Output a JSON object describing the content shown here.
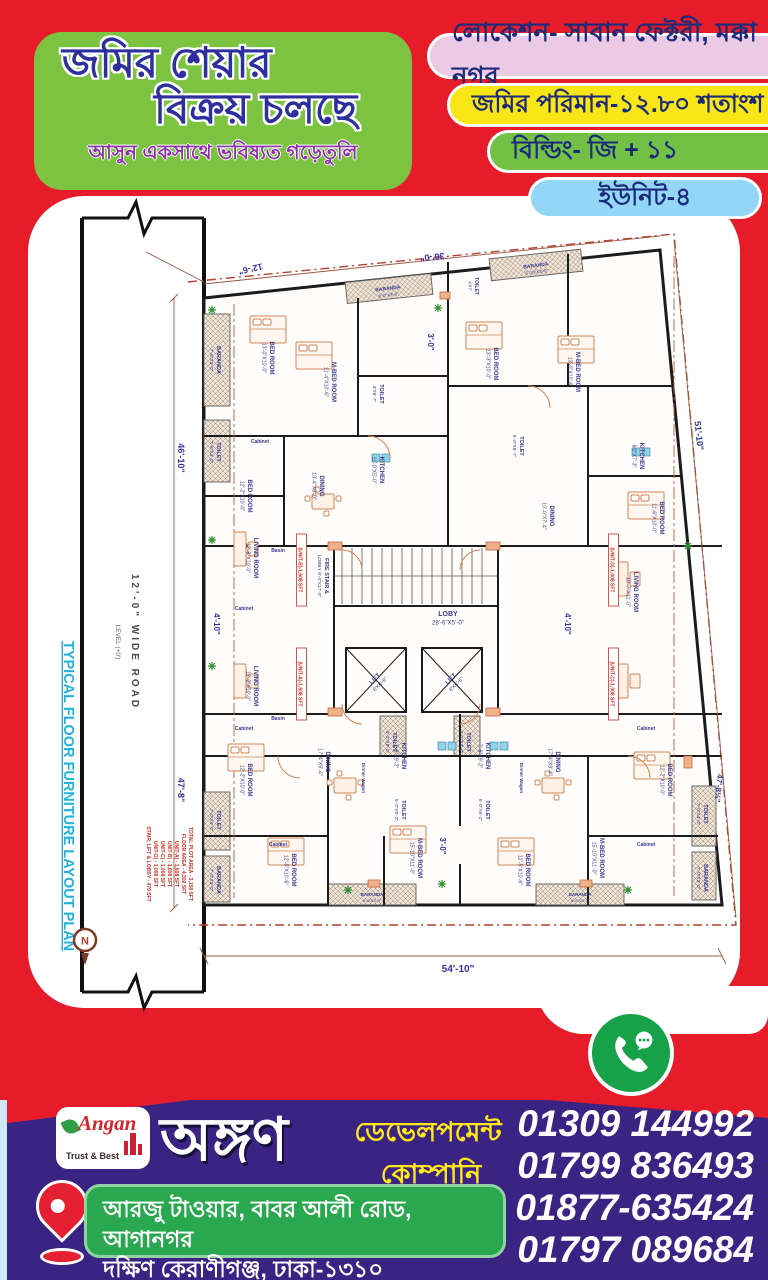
{
  "poster": {
    "title_line1": "জমির শেয়ার",
    "title_line2": "বিক্রয় চলছে",
    "subtitle": "আসুন একসাথে ভবিষ্যত গড়েতুলি",
    "badges": [
      {
        "label": "লোকেশন- সাবান ফেক্টরী, মক্কা নগর"
      },
      {
        "label": "জমির পরিমান-১২.৮০ শতাংশ"
      },
      {
        "label": "বিল্ডিং- জি + ১১"
      },
      {
        "label": "ইউনিট-৪"
      }
    ]
  },
  "colors": {
    "background_red": "#e61c2a",
    "title_card_green": "#7cc342",
    "badge_pink": "#ecc9e4",
    "badge_yellow": "#f8e616",
    "badge_green": "#72c045",
    "badge_cyan": "#93d6f5",
    "banner_purple": "#3a2383",
    "address_green": "#2aa84f",
    "phone_circle_green": "#17a149",
    "dim_text_navy": "#34349a",
    "area_text_red": "#cc2b1f"
  },
  "plan": {
    "side": {
      "road": "12'-0\" WIDE ROAD",
      "road_level": "LEVEL (+0')",
      "plan_title": "TYPICAL FLOOR FURNITURE LAYOUT PLAN",
      "compass": "N"
    },
    "dims": [
      {
        "t": "12'-6\"",
        "x": 222,
        "y": 70,
        "r": 167,
        "s": 9
      },
      {
        "t": "36'-0\"",
        "x": 404,
        "y": 58,
        "r": 174,
        "s": 9
      },
      {
        "t": "51'-10\"",
        "x": 668,
        "y": 240,
        "r": 84,
        "s": 9
      },
      {
        "t": "46'-10\"",
        "x": 150,
        "y": 262,
        "r": 90,
        "s": 9
      },
      {
        "t": "47'-8\"",
        "x": 150,
        "y": 594,
        "r": 90,
        "s": 9
      },
      {
        "t": "4'-10\"",
        "x": 186,
        "y": 428,
        "r": 90,
        "s": 8
      },
      {
        "t": "4'-10\"",
        "x": 537,
        "y": 428,
        "r": 90,
        "s": 8
      },
      {
        "t": "3'-0\"",
        "x": 400,
        "y": 146,
        "r": 90,
        "s": 8
      },
      {
        "t": "3'-0\"",
        "x": 412,
        "y": 650,
        "r": 90,
        "s": 8
      },
      {
        "t": "47'-8½\"",
        "x": 688,
        "y": 592,
        "r": 96,
        "s": 8
      },
      {
        "t": "54'-10\"",
        "x": 430,
        "y": 776,
        "r": 0,
        "s": 10
      }
    ],
    "rooms": [
      {
        "n": "LOBY",
        "d": "28'-6\"X5'-0\"",
        "x": 420,
        "y": 420,
        "r": 0,
        "s": 7
      },
      {
        "n": "FIRE STAIR &",
        "d": "LOBBY 8'-0\"X17'-0\"",
        "x": 297,
        "y": 380,
        "r": 90,
        "s": 5.5
      },
      {
        "n": "LIFT",
        "d": "6'X6'-6\"",
        "x": 348,
        "y": 484,
        "r": -45,
        "s": 6
      },
      {
        "n": "LIFT",
        "d": "6'X6'-6\"",
        "x": 424,
        "y": 484,
        "r": -45,
        "s": 6
      },
      {
        "n": "Basin",
        "x": 250,
        "y": 356,
        "r": 0,
        "s": 5
      },
      {
        "n": "Basin",
        "x": 250,
        "y": 524,
        "r": 0,
        "s": 5
      },
      {
        "n": "TOILET",
        "d": "4'-2\"X8'-0\"",
        "x": 365,
        "y": 546,
        "r": 90,
        "s": 5.5
      },
      {
        "n": "TOILET",
        "d": "4'-2\"X8'-0\"",
        "x": 439,
        "y": 546,
        "r": 90,
        "s": 5.5
      },
      {
        "n": "BARANDA",
        "d": "7'-6\"X3'-0\"",
        "x": 189,
        "y": 164,
        "r": 90,
        "s": 5.5
      },
      {
        "n": "BED ROOM",
        "d": "13'-0\"X10'-0\"",
        "x": 242,
        "y": 162,
        "r": 90,
        "s": 6
      },
      {
        "n": "M-BED ROOM",
        "d": "11'-4\"X10'-6\"",
        "x": 304,
        "y": 186,
        "r": 90,
        "s": 6
      },
      {
        "n": "TOILET",
        "d": "7'-6\"X4'-0\"",
        "x": 189,
        "y": 256,
        "r": 90,
        "s": 5.5
      },
      {
        "n": "Cabinet",
        "x": 232,
        "y": 247,
        "r": 0,
        "s": 5
      },
      {
        "n": "BED ROOM",
        "d": "12'-2\"X10'-0\"",
        "x": 220,
        "y": 300,
        "r": 90,
        "s": 6
      },
      {
        "n": "DINING",
        "d": "13'-4\"X8'-0\"",
        "x": 292,
        "y": 290,
        "r": 90,
        "s": 6
      },
      {
        "n": "KITCHEN",
        "d": "11'-0\"X5'-0\"",
        "x": 352,
        "y": 274,
        "r": 90,
        "s": 6
      },
      {
        "n": "TOILET",
        "d": "4'X6'-7\"",
        "x": 352,
        "y": 198,
        "r": 90,
        "s": 5.5
      },
      {
        "n": "LIVING ROOM",
        "d": "12'-8\"X10'-0\"",
        "x": 226,
        "y": 362,
        "r": 90,
        "s": 6
      },
      {
        "n": "Cabinet",
        "x": 216,
        "y": 414,
        "r": 0,
        "s": 5
      },
      {
        "n": "BARANDA",
        "d": "8'-0\"X3'-0\"",
        "x": 360,
        "y": 94,
        "r": -7,
        "s": 5
      },
      {
        "n": "TOILET",
        "d": "4'X7'",
        "x": 447,
        "y": 90,
        "r": 90,
        "s": 5
      },
      {
        "n": "BARANDA",
        "d": "5'-10\"X3'-0\"",
        "x": 508,
        "y": 71,
        "r": -7,
        "s": 5
      },
      {
        "n": "BED ROOM",
        "d": "13'-3\"X10'-0\"",
        "x": 466,
        "y": 168,
        "r": 90,
        "s": 6
      },
      {
        "n": "M-BED ROOM",
        "d": "13'-0\"X10'-6\"",
        "x": 548,
        "y": 176,
        "r": 90,
        "s": 6
      },
      {
        "n": "KITCHEN",
        "d": "6'0\"X7'-3\"",
        "x": 612,
        "y": 260,
        "r": 90,
        "s": 6
      },
      {
        "n": "TOILET",
        "d": "5'-0\"X6'-7\"",
        "x": 492,
        "y": 250,
        "r": 90,
        "s": 5.5
      },
      {
        "n": "DINING",
        "d": "10'-0\"X7'-4\"",
        "x": 522,
        "y": 320,
        "r": 90,
        "s": 6
      },
      {
        "n": "BED ROOM",
        "d": "11'-6\"X10'-0\"",
        "x": 632,
        "y": 322,
        "r": 90,
        "s": 6
      },
      {
        "n": "LIVING ROOM",
        "d": "10'-7\"X11'-0\"",
        "x": 606,
        "y": 396,
        "r": 90,
        "s": 6
      },
      {
        "n": "LIVING ROOM",
        "d": "12'-2\"X10'-0\"",
        "x": 226,
        "y": 490,
        "r": 90,
        "s": 6
      },
      {
        "n": "Cabinet",
        "x": 216,
        "y": 534,
        "r": 0,
        "s": 5
      },
      {
        "n": "BED ROOM",
        "d": "12'-2\"X10'-0\"",
        "x": 220,
        "y": 584,
        "r": 90,
        "s": 6
      },
      {
        "n": "DINING",
        "d": "17'-4\"X9'-4\"",
        "x": 298,
        "y": 566,
        "r": 90,
        "s": 6
      },
      {
        "n": "Dinner Wagon",
        "x": 334,
        "y": 582,
        "r": 90,
        "s": 4.5
      },
      {
        "n": "KITCHEN",
        "d": "7'-6\"X9'-2\"",
        "x": 374,
        "y": 560,
        "r": 90,
        "s": 6
      },
      {
        "n": "TOILET",
        "d": "5'-0\"X5'-2\"",
        "x": 374,
        "y": 614,
        "r": 90,
        "s": 5.5
      },
      {
        "n": "TOILET",
        "d": "7'-0\"X4'-0\"",
        "x": 189,
        "y": 624,
        "r": 90,
        "s": 5.5
      },
      {
        "n": "BARANDA",
        "d": "7'-0\"X3'-0\"",
        "x": 189,
        "y": 684,
        "r": 90,
        "s": 5.5
      },
      {
        "n": "Cabinet",
        "x": 250,
        "y": 650,
        "r": 0,
        "s": 5
      },
      {
        "n": "M-BED ROOM",
        "d": "15'-10\"X11'-0\"",
        "x": 390,
        "y": 662,
        "r": 90,
        "s": 6
      },
      {
        "n": "BED ROOM",
        "d": "12'-5\"X10'-6\"",
        "x": 264,
        "y": 674,
        "r": 90,
        "s": 6
      },
      {
        "n": "BARANDA",
        "d": "8'-0\"X3'-0\"",
        "x": 344,
        "y": 700,
        "r": 0,
        "s": 4.5
      },
      {
        "n": "BED ROOM",
        "d": "12'-5\"X10'-6\"",
        "x": 498,
        "y": 674,
        "r": 90,
        "s": 6
      },
      {
        "n": "M-BED ROOM",
        "d": "15'-10\"X11'-0\"",
        "x": 572,
        "y": 662,
        "r": 90,
        "s": 6
      },
      {
        "n": "BARANDA",
        "d": "8'-0\"X3'-0\"",
        "x": 552,
        "y": 700,
        "r": 0,
        "s": 4.5
      },
      {
        "n": "Cabinet",
        "x": 618,
        "y": 650,
        "r": 0,
        "s": 5
      },
      {
        "n": "TOILET",
        "d": "7'-0\"X4'-0\"",
        "x": 676,
        "y": 618,
        "r": 90,
        "s": 5.5
      },
      {
        "n": "BARANDA",
        "d": "7'-0\"X3'-0\"",
        "x": 676,
        "y": 682,
        "r": 90,
        "s": 5.5
      },
      {
        "n": "BED ROOM",
        "d": "12'-2\"X10'-0\"",
        "x": 640,
        "y": 584,
        "r": 90,
        "s": 6
      },
      {
        "n": "DINING",
        "d": "17'-4\"X9'-4\"",
        "x": 528,
        "y": 566,
        "r": 90,
        "s": 6
      },
      {
        "n": "Dinner Wagon",
        "x": 492,
        "y": 582,
        "r": 90,
        "s": 4.5
      },
      {
        "n": "KITCHEN",
        "d": "7'-6\"X9'-2\"",
        "x": 458,
        "y": 560,
        "r": 90,
        "s": 6
      },
      {
        "n": "TOILET",
        "d": "5'-0\"X5'-2\"",
        "x": 458,
        "y": 614,
        "r": 90,
        "s": 5.5
      },
      {
        "n": "Cabinet",
        "x": 618,
        "y": 534,
        "r": 0,
        "s": 5
      }
    ],
    "unit_tags": [
      {
        "t": "(UNIT-B)-1,608 SFT",
        "x": 272,
        "y": 374,
        "r": 90
      },
      {
        "t": "(UNIT-D)-1,008 SFT",
        "x": 584,
        "y": 374,
        "r": 90
      },
      {
        "t": "(UNIT-A)-1,608 SFT",
        "x": 272,
        "y": 488,
        "r": 90
      },
      {
        "t": "(UNIT-C)-1,008 SFT",
        "x": 584,
        "y": 488,
        "r": 90
      }
    ],
    "area_table": [
      "TOTAL PLOT AREA - 3,158 SFT",
      "FLOOR AREA - 4,302 SFT",
      "UNIT-A) - 1,608 SFT",
      "UNIT-B) - 1,608 SFT",
      "UNIT-C) - 1,008 SFT",
      "UNIT-D) - 1,008 SFT",
      "STAIR, LIFT & LOBBY - 470 SFT"
    ]
  },
  "footer": {
    "logo": {
      "name": "Angan",
      "tagline": "Trust & Best"
    },
    "company_bn": "অঙ্গণ",
    "company_type_line1": "ডেভেলপমেন্ট",
    "company_type_line2": "কোম্পানি",
    "phones": [
      "01309 144992",
      "01799 836493",
      "01877-635424",
      "01797 089684"
    ],
    "address_line1": "আরজু টাওয়ার, বাবর আলী রোড, আগানগর",
    "address_line2": "দক্ষিণ কেরাণীগঞ্জ, ঢাকা-১৩১০"
  }
}
